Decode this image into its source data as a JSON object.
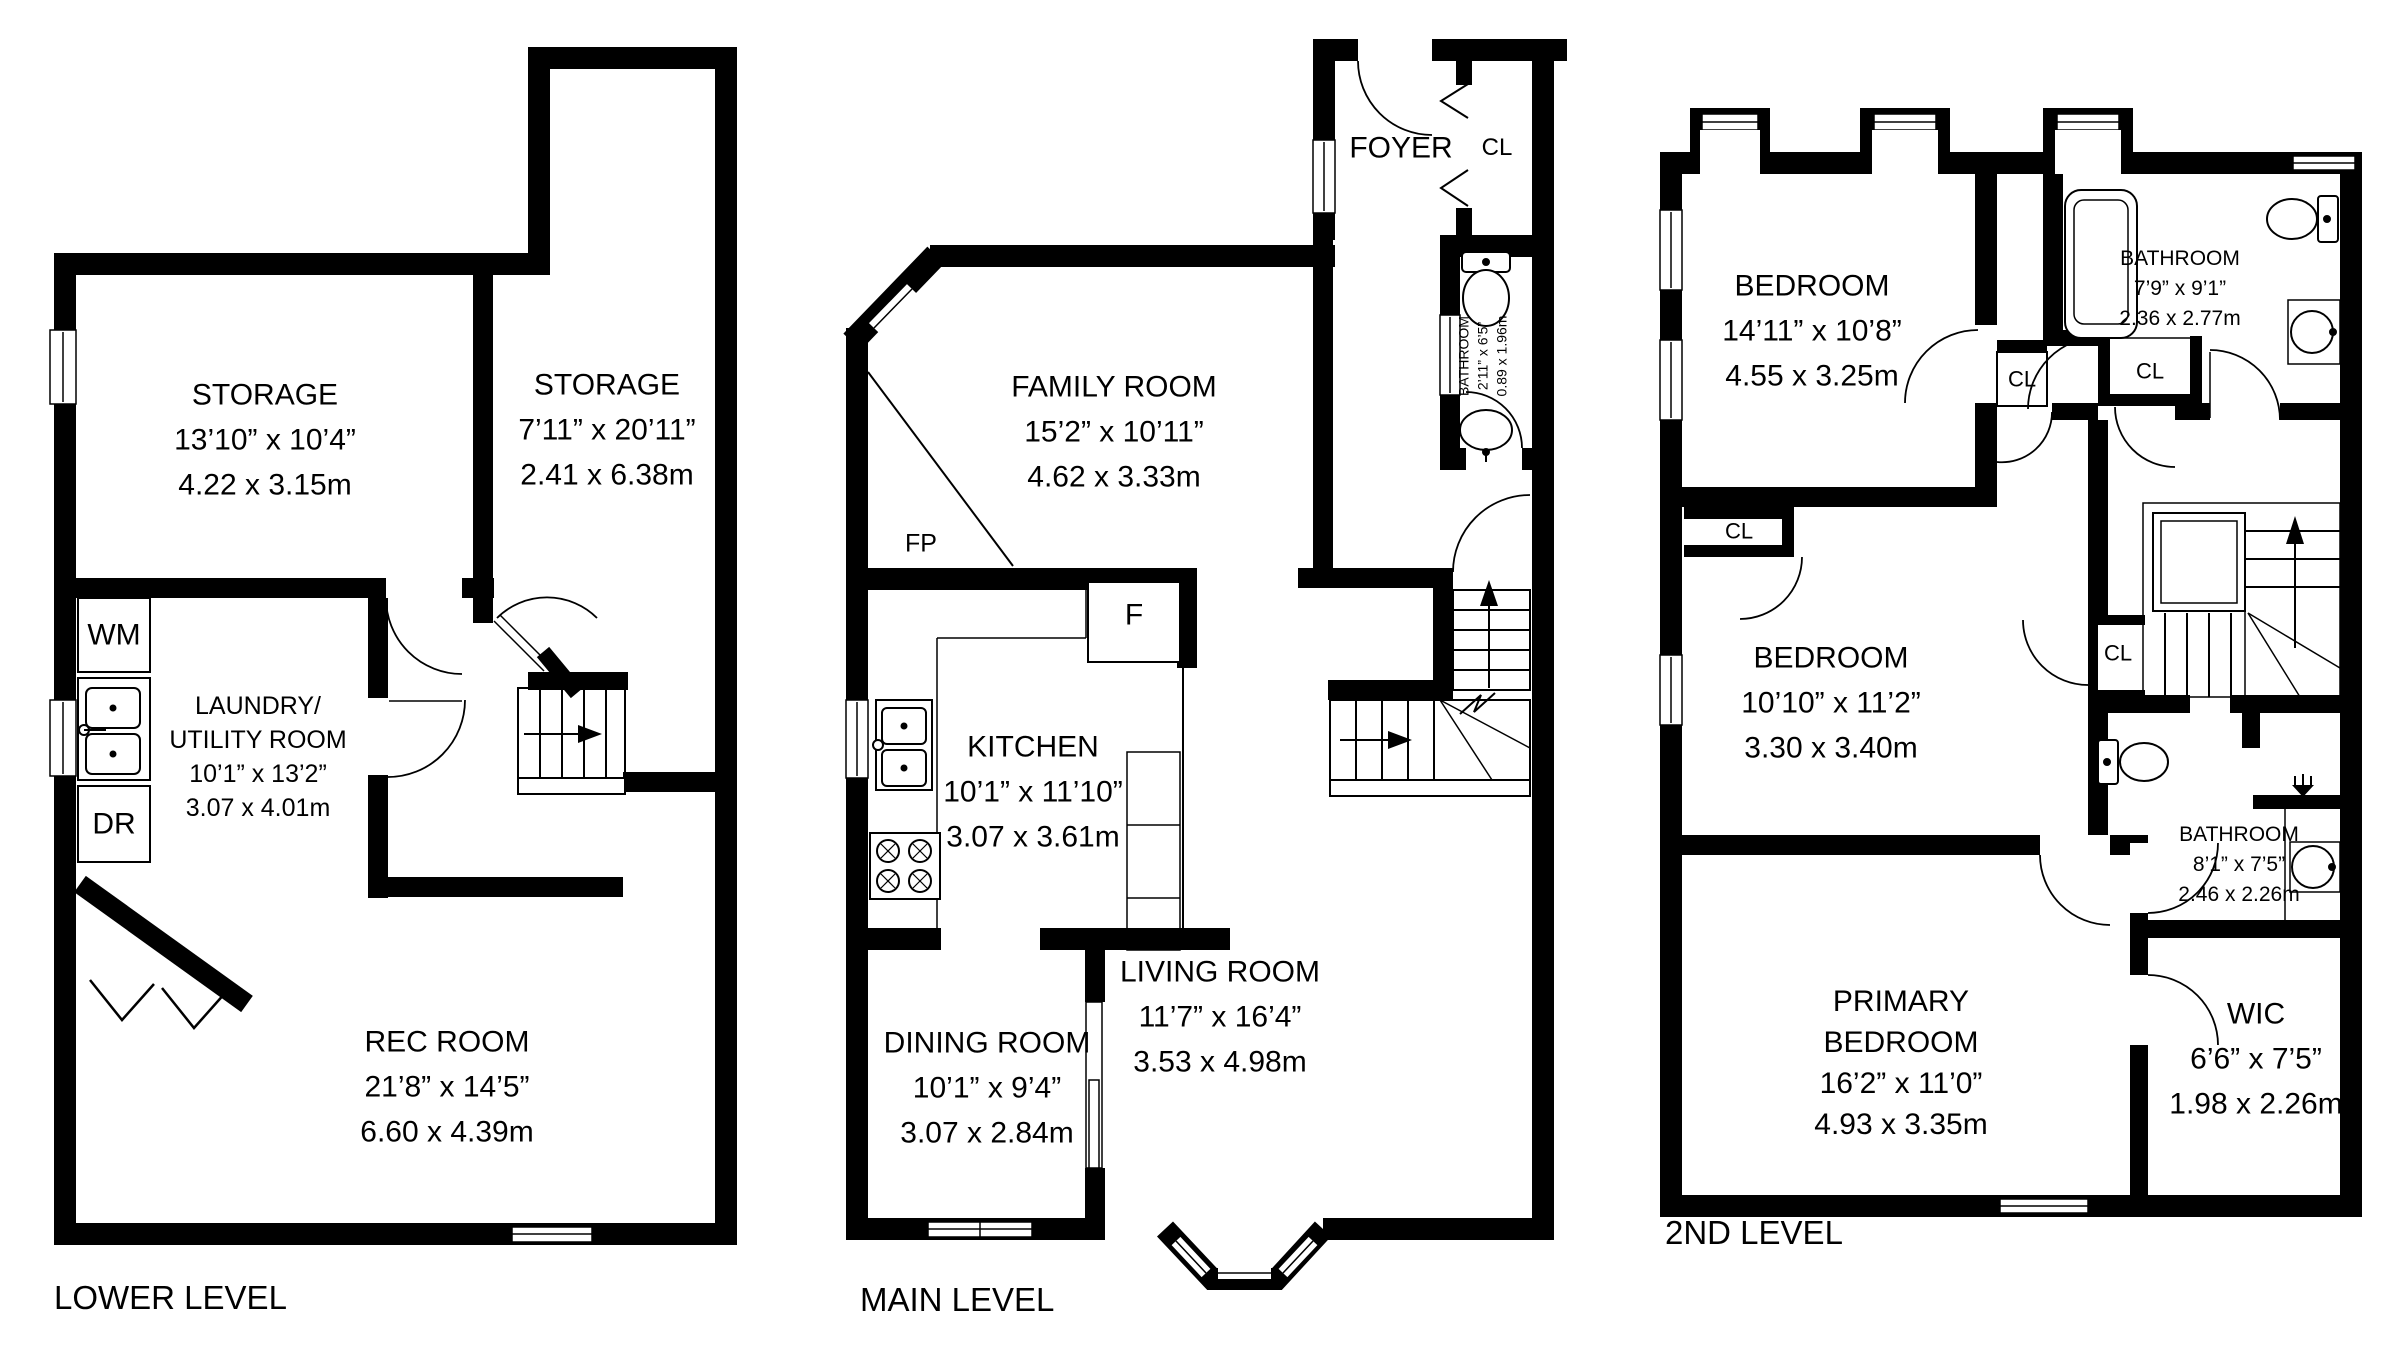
{
  "levels": {
    "lower": {
      "title": "LOWER LEVEL",
      "rooms": {
        "storage1": {
          "lines": [
            "STORAGE",
            "13’10” x 10’4”",
            "4.22 x 3.15m"
          ]
        },
        "storage2": {
          "lines": [
            "STORAGE",
            "7’11” x 20’11”",
            "2.41 x 6.38m"
          ]
        },
        "laundry": {
          "lines": [
            "LAUNDRY/",
            "UTILITY ROOM",
            "10’1” x 13’2”",
            "3.07 x 4.01m"
          ]
        },
        "rec": {
          "lines": [
            "REC ROOM",
            "21’8” x 14’5”",
            "6.60 x 4.39m"
          ]
        }
      },
      "fixtures": {
        "wm": "WM",
        "dr": "DR"
      }
    },
    "main": {
      "title": "MAIN LEVEL",
      "rooms": {
        "foyer": {
          "lines": [
            "FOYER"
          ]
        },
        "family": {
          "lines": [
            "FAMILY ROOM",
            "15’2” x 10’11”",
            "4.62 x 3.33m"
          ]
        },
        "bath": {
          "lines": [
            "BATHROOM",
            "2’11” x 6’5”",
            "0.89 x 1.96m"
          ]
        },
        "kitchen": {
          "lines": [
            "KITCHEN",
            "10’1” x 11’10”",
            "3.07 x 3.61m"
          ]
        },
        "dining": {
          "lines": [
            "DINING ROOM",
            "10’1” x 9’4”",
            "3.07 x 2.84m"
          ]
        },
        "living": {
          "lines": [
            "LIVING ROOM",
            "11’7” x 16’4”",
            "3.53 x 4.98m"
          ]
        }
      },
      "fixtures": {
        "cl": "CL",
        "fridge": "F",
        "fireplace": "FP"
      }
    },
    "second": {
      "title": "2ND LEVEL",
      "rooms": {
        "bedroom1": {
          "lines": [
            "BEDROOM",
            "14’11” x 10’8”",
            "4.55 x 3.25m"
          ]
        },
        "bath1": {
          "lines": [
            "BATHROOM",
            "7’9” x 9’1”",
            "2.36 x 2.77m"
          ]
        },
        "bedroom2": {
          "lines": [
            "BEDROOM",
            "10’10” x 11’2”",
            "3.30 x 3.40m"
          ]
        },
        "bath2": {
          "lines": [
            "BATHROOM",
            "8’1” x 7’5”",
            "2.46 x 2.26m"
          ]
        },
        "primary": {
          "lines": [
            "PRIMARY",
            "BEDROOM",
            "16’2” x 11’0”",
            "4.93 x 3.35m"
          ]
        },
        "wic": {
          "lines": [
            "WIC",
            "6’6” x 7’5”",
            "1.98 x 2.26m"
          ]
        }
      },
      "fixtures": {
        "cl": "CL"
      }
    }
  }
}
